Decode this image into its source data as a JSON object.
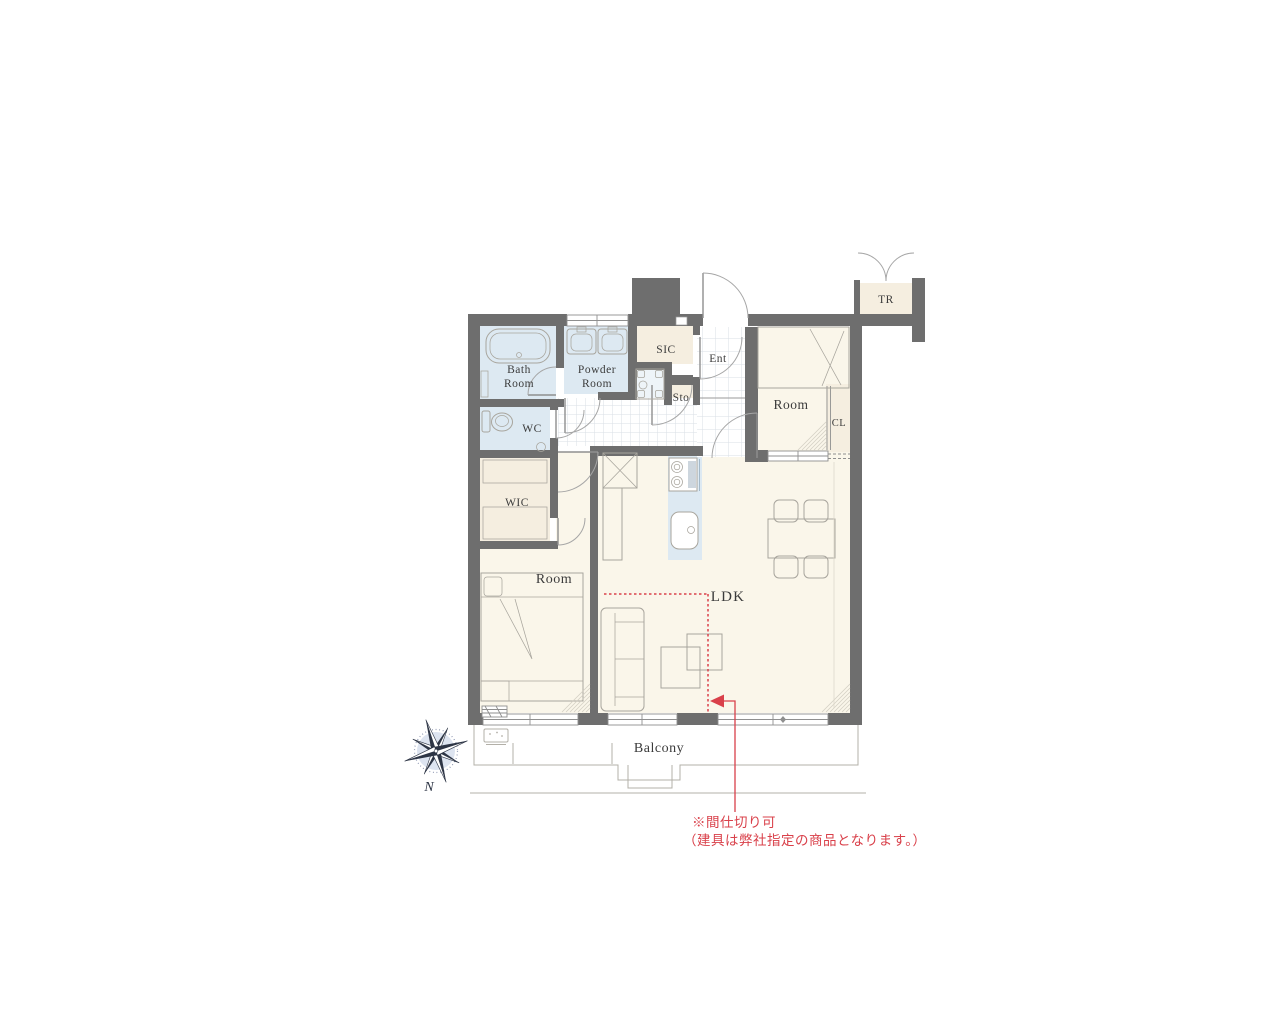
{
  "colors": {
    "wall": "#6e6e6e",
    "wet": "#dde9f2",
    "cream": "#faf6ea",
    "closet": "#f5eee0",
    "gridline": "#dadfe6",
    "line": "#a8a59d",
    "ink": "#3b3b3b",
    "red": "#d9404a",
    "balcony_line": "#b3b0a8",
    "compass": "#2d3545",
    "compass_light": "#dde4f0"
  },
  "plan": {
    "rooms": {
      "bath": [
        "Bath",
        "Room"
      ],
      "powder": [
        "Powder",
        "Room"
      ],
      "wc": "WC",
      "wic": "WIC",
      "sic": "SIC",
      "sto": "Sto",
      "ent": "Ent",
      "bedroom_west": "Room",
      "bedroom_north": "Room",
      "closet": "CL",
      "trunk_room": "TR",
      "ldk": "LDK",
      "balcony": "Balcony"
    },
    "compass": {
      "north": "N"
    },
    "note": {
      "line1": "※間仕切り可",
      "line2": "（建具は弊社指定の商品となります。）"
    }
  }
}
